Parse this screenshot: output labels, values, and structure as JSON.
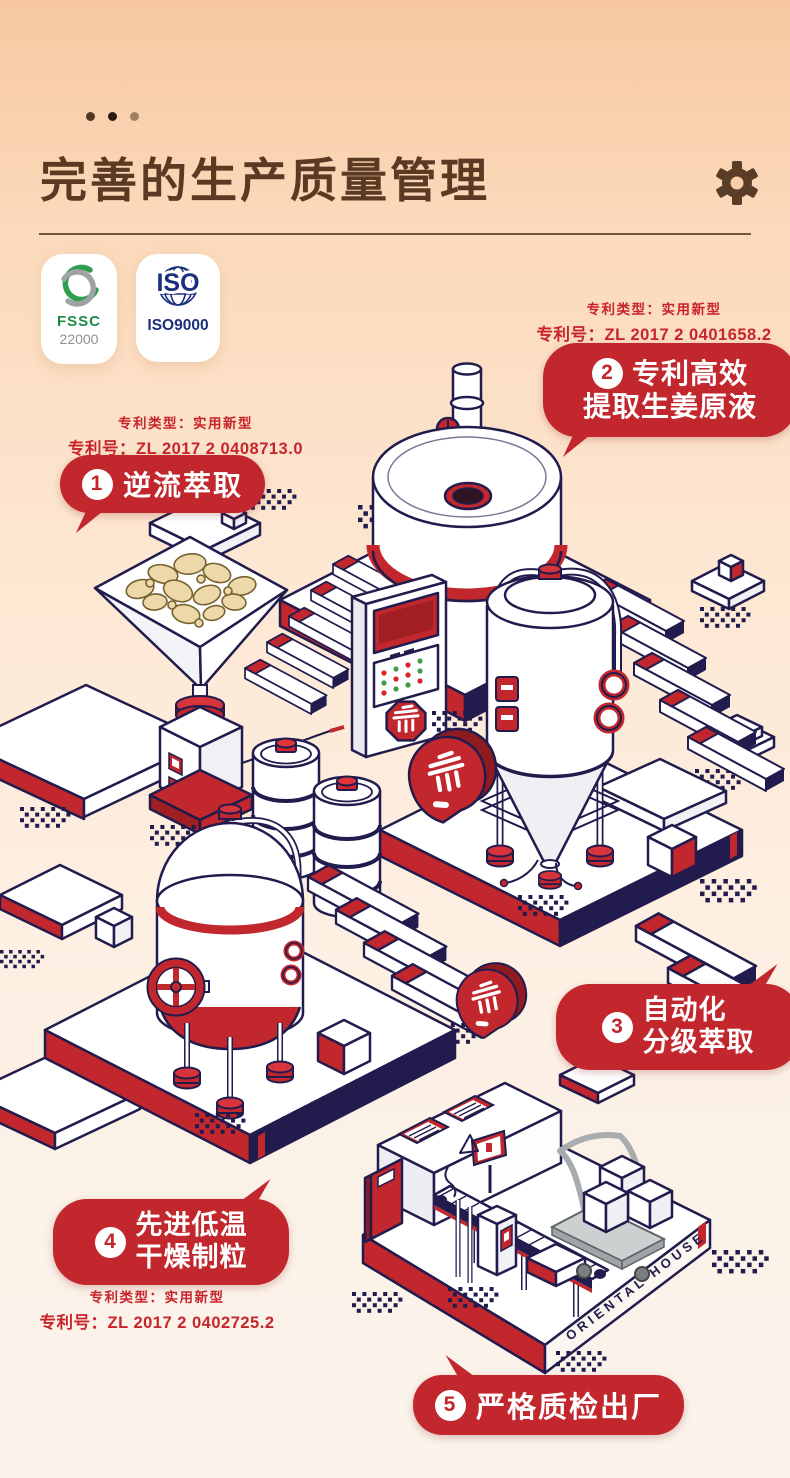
{
  "header": {
    "title": "完善的生产质量管理"
  },
  "certifications": {
    "fssc": {
      "line1": "FSSC",
      "line2": "22000"
    },
    "iso": {
      "logo": "ISO",
      "label": "ISO9000"
    }
  },
  "steps": [
    {
      "num": "1",
      "line1": "逆流萃取",
      "patent_type": "专利类型：实用新型",
      "patent_no": "专利号：ZL 2017 2 0408713.0"
    },
    {
      "num": "2",
      "line1": "专利高效",
      "line2": "提取生姜原液",
      "patent_type": "专利类型：实用新型",
      "patent_no": "专利号：ZL 2017 2 0401658.2"
    },
    {
      "num": "3",
      "line1": "自动化",
      "line2": "分级萃取"
    },
    {
      "num": "4",
      "line1": "先进低温",
      "line2": "干燥制粒",
      "patent_type": "专利类型：实用新型",
      "patent_no": "专利号：ZL 2017 2 0402725.2"
    },
    {
      "num": "5",
      "line1": "严格质检出厂"
    }
  ],
  "illustration": {
    "platform_label": "ORIENTAL HOUSE",
    "platform_label_partial": "HOUSE"
  },
  "colors": {
    "accent_red": "#c1272d",
    "outline_navy": "#221c4e",
    "title_brown": "#5a3a22",
    "ginger_tan": "#ecd8a8"
  }
}
